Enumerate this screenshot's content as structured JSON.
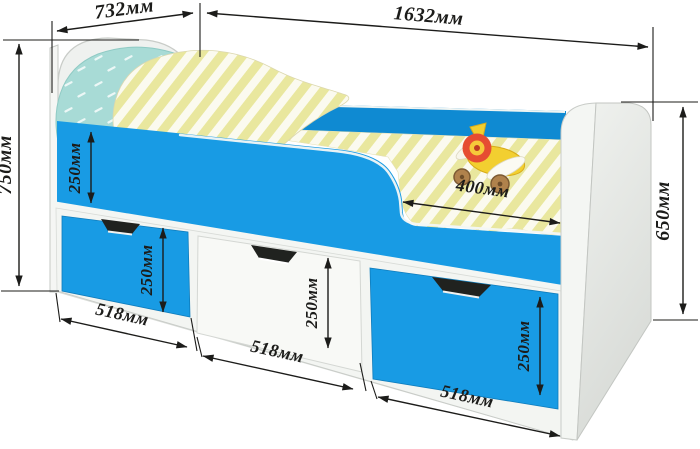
{
  "figure": {
    "kind": "furniture dimension diagram",
    "subject": "children's bed with guard rail and three storage drawers",
    "unit": "мм"
  },
  "labels": {
    "headboard_width": "732мм",
    "bed_length": "1632мм",
    "overall_height": "750мм",
    "footboard_height": "650мм",
    "side_rail_height": "250мм",
    "drawer_left_height": "250мм",
    "drawer_middle_height": "250мм",
    "drawer_right_height": "250мм",
    "opening_width": "400мм",
    "drawer_left_width": "518мм",
    "drawer_middle_width": "518мм",
    "drawer_right_width": "518мм"
  },
  "colors": {
    "bed_blue": "#189be4",
    "far_rail_blue": "#0f8ad2",
    "dimension_ink": "#1c1c1a",
    "pillow_teal": "#a8dbd6",
    "stripe_yellow": "#e9e79e",
    "toy_red": "#e64d32",
    "toy_yellow": "#f2cf30",
    "wheel_brown": "#b0824c"
  }
}
